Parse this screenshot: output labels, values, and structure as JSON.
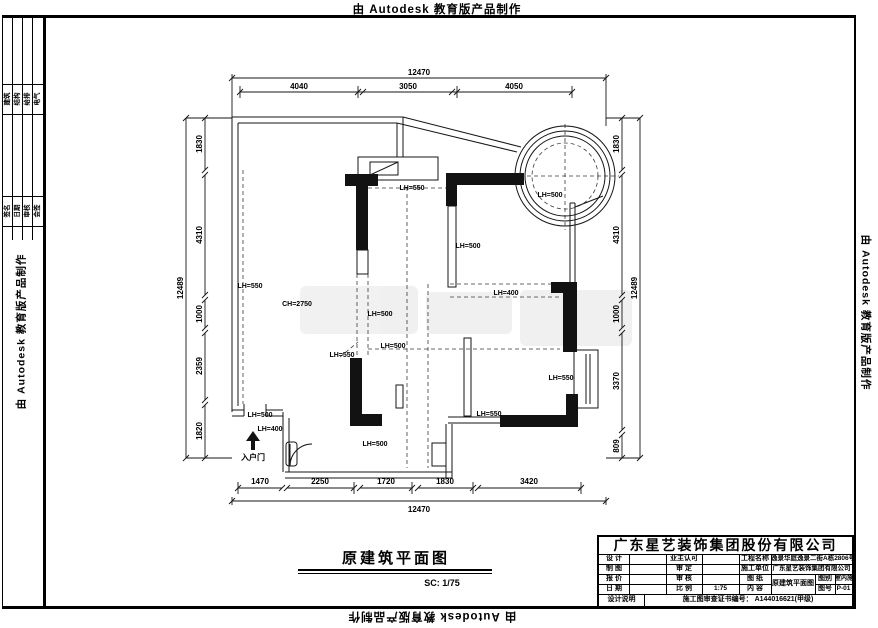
{
  "watermark": "由 Autodesk 教育版产品制作",
  "footer": {
    "title": "原建筑平面图",
    "scale": "SC: 1/75"
  },
  "entry": {
    "label": "入户门"
  },
  "plan_labels": [
    "LH=550",
    "CH=2750",
    "LH=500",
    "LH=500",
    "LH=550",
    "LH=400",
    "LH=500",
    "LH=500",
    "LH=550",
    "LH=500",
    "LH=400",
    "LH=500",
    "LH=550",
    "LH=550"
  ],
  "dims": {
    "top": {
      "total": "12470",
      "segs": [
        "4040",
        "3050",
        "4050"
      ]
    },
    "bottom": {
      "total": "12470",
      "segs": [
        "1470",
        "2250",
        "1720",
        "1830",
        "3420"
      ]
    },
    "left": {
      "total": "12489",
      "segs": [
        "1830",
        "4310",
        "1000",
        "2359",
        "1820"
      ]
    },
    "right": {
      "total": "12489",
      "segs": [
        "1830",
        "4310",
        "1000",
        "3370",
        "809"
      ]
    }
  },
  "side_table": {
    "group1": [
      "建筑",
      "结构",
      "给排",
      "电气"
    ],
    "group2": [
      "签名",
      "日期",
      "审核",
      "会签"
    ]
  },
  "tb": {
    "company": "广东星艺装饰集团股份有限公司",
    "l_design": "设 计",
    "l_owner": "业主认可",
    "l_project": "工程名称",
    "v_project": "逸景华庭逸景二街A栋2806号",
    "l_draft": "制 图",
    "l_approve": "审 定",
    "l_builder": "施工单位",
    "v_builder": "广东星艺装饰集团有限公司",
    "l_quote": "报 价",
    "l_check": "审 核",
    "l_sheet": "图 纸",
    "l_cat": "图别",
    "v_cat": "室内施",
    "l_date": "日 期",
    "l_scale": "比 例",
    "v_scale": "1:75",
    "l_content": "内 容",
    "l_no": "图号",
    "v_no": "P-01",
    "v_content": "原建筑平面图",
    "l_note": "设计说明",
    "cert_label": "施工图审查证书编号：",
    "cert_no": "A144016621(甲级)"
  }
}
